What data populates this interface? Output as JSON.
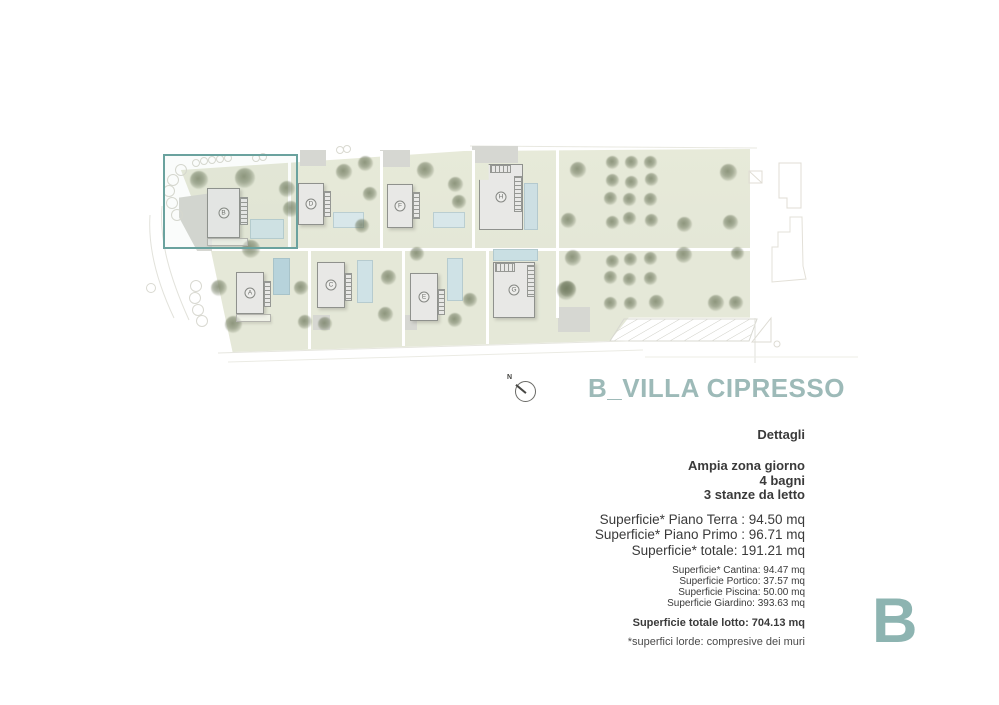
{
  "title": "B_VILLA CIPRESSO",
  "plan": {
    "north_label": "N",
    "highlighted_building": "B",
    "buildings": [
      {
        "label": "A"
      },
      {
        "label": "B"
      },
      {
        "label": "C"
      },
      {
        "label": "D"
      },
      {
        "label": "E"
      },
      {
        "label": "F"
      },
      {
        "label": "G"
      },
      {
        "label": "H"
      }
    ]
  },
  "details": {
    "heading": "Dettagli",
    "features": [
      "Ampia zona giorno",
      "4 bagni",
      "3 stanze da letto"
    ],
    "surfaces_main": [
      "Superficie* Piano Terra : 94.50 mq",
      "Superficie* Piano Primo : 96.71 mq",
      "Superficie* totale: 191.21 mq"
    ],
    "surfaces_secondary": [
      "Superficie* Cantina: 94.47 mq",
      "Superficie Portico: 37.57 mq",
      "Superficie Piscina: 50.00 mq",
      "Superficie Giardino: 393.63 mq"
    ],
    "total_lot": "Superficie totale lotto: 704.13 mq",
    "footnote": "*superfici lorde: compresive dei muri"
  },
  "watermark": "B",
  "colors": {
    "accent": "#9dbab8",
    "watermark": "#8db4b1",
    "highlight_border": "#6aa29e",
    "text": "#3a3a3a"
  }
}
